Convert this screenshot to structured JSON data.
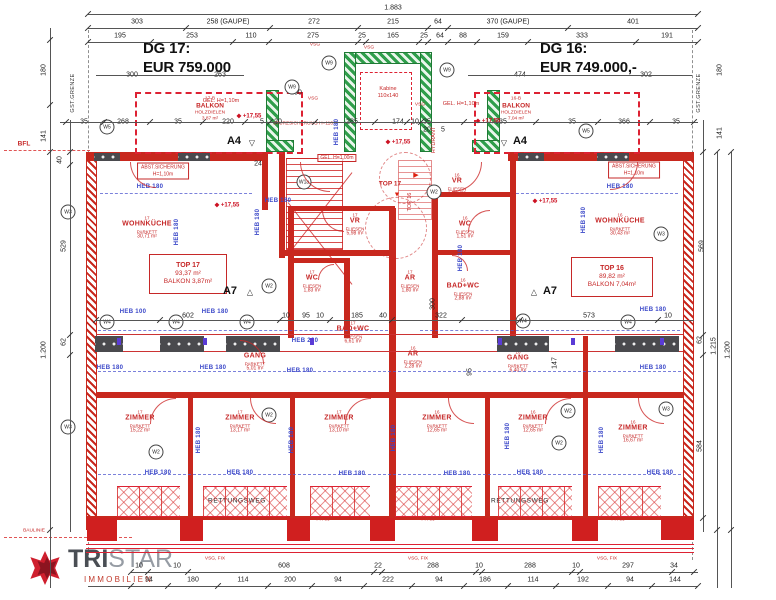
{
  "colors": {
    "wall_red": "#c8281e",
    "core_green": "#2f9e4b",
    "heb_blue": "#3946c8",
    "dim_text": "#222222",
    "room_red": "#c62828",
    "price_text": "#111111",
    "logo_red": "#c0392b"
  },
  "prices": {
    "left_label": "DG 17:",
    "left_value": "EUR 759.000",
    "right_label": "DG 16:",
    "right_value": "EUR 749.000,-"
  },
  "logo": {
    "word_bold": "TRI",
    "word_light": "STAR",
    "subtitle": "IMMOBILIEN"
  },
  "level_icon": "◆",
  "dim_rows": [
    {
      "y": 8,
      "items": [
        {
          "t": "1.883",
          "x": 393
        }
      ]
    },
    {
      "y": 22,
      "items": [
        {
          "t": "303",
          "x": 137
        },
        {
          "t": "258 (GAUPE)",
          "x": 228
        },
        {
          "t": "272",
          "x": 314
        },
        {
          "t": "215",
          "x": 393
        },
        {
          "t": "64",
          "x": 438
        },
        {
          "t": "370 (GAUPE)",
          "x": 508
        },
        {
          "t": "401",
          "x": 633
        }
      ]
    },
    {
      "y": 36,
      "items": [
        {
          "t": "195",
          "x": 120
        },
        {
          "t": "253",
          "x": 192
        },
        {
          "t": "110",
          "x": 251
        },
        {
          "t": "275",
          "x": 313
        },
        {
          "t": "25",
          "x": 362
        },
        {
          "t": "165",
          "x": 393
        },
        {
          "t": "25",
          "x": 424
        },
        {
          "t": "64",
          "x": 440
        },
        {
          "t": "88",
          "x": 463
        },
        {
          "t": "159",
          "x": 503
        },
        {
          "t": "333",
          "x": 582
        },
        {
          "t": "191",
          "x": 667
        }
      ]
    },
    {
      "y": 75,
      "items": [
        {
          "t": "300",
          "x": 132
        },
        {
          "t": "263",
          "x": 220
        },
        {
          "t": "474",
          "x": 520
        },
        {
          "t": "302",
          "x": 646
        }
      ]
    },
    {
      "y": 93,
      "items": [
        {
          "t": "100",
          "x": 296
        }
      ]
    },
    {
      "y": 122,
      "items": [
        {
          "t": "35",
          "x": 84
        },
        {
          "t": "268",
          "x": 123
        },
        {
          "t": "35",
          "x": 178
        },
        {
          "t": "220",
          "x": 228
        },
        {
          "t": "5",
          "x": 262
        },
        {
          "t": "20",
          "x": 278
        },
        {
          "t": "285",
          "x": 352
        },
        {
          "t": "174",
          "x": 398
        },
        {
          "t": "10",
          "x": 415
        },
        {
          "t": "35",
          "x": 427
        },
        {
          "t": "335",
          "x": 501
        },
        {
          "t": "35",
          "x": 572
        },
        {
          "t": "366",
          "x": 624
        },
        {
          "t": "35",
          "x": 676
        }
      ]
    },
    {
      "y": 130,
      "items": [
        {
          "t": "20",
          "x": 427
        },
        {
          "t": "5",
          "x": 443
        }
      ]
    },
    {
      "y": 164,
      "items": [
        {
          "t": "24",
          "x": 258
        }
      ]
    },
    {
      "y": 316,
      "items": [
        {
          "t": "602",
          "x": 188
        },
        {
          "t": "10",
          "x": 286
        },
        {
          "t": "95",
          "x": 306
        },
        {
          "t": "10",
          "x": 320
        },
        {
          "t": "185",
          "x": 357
        },
        {
          "t": "40",
          "x": 383
        },
        {
          "t": "322",
          "x": 441
        },
        {
          "t": "573",
          "x": 589
        },
        {
          "t": "10",
          "x": 668
        }
      ]
    },
    {
      "y": 566,
      "items": [
        {
          "t": "10",
          "x": 139
        },
        {
          "t": "10",
          "x": 177
        },
        {
          "t": "608",
          "x": 284
        },
        {
          "t": "22",
          "x": 378
        },
        {
          "t": "288",
          "x": 433
        },
        {
          "t": "10",
          "x": 479
        },
        {
          "t": "288",
          "x": 530
        },
        {
          "t": "10",
          "x": 576
        },
        {
          "t": "297",
          "x": 628
        },
        {
          "t": "34",
          "x": 674
        }
      ]
    },
    {
      "y": 580,
      "items": [
        {
          "t": "94",
          "x": 149
        },
        {
          "t": "180",
          "x": 193
        },
        {
          "t": "114",
          "x": 243
        },
        {
          "t": "200",
          "x": 290
        },
        {
          "t": "94",
          "x": 338
        },
        {
          "t": "222",
          "x": 388
        },
        {
          "t": "94",
          "x": 439
        },
        {
          "t": "186",
          "x": 485
        },
        {
          "t": "114",
          "x": 533
        },
        {
          "t": "192",
          "x": 583
        },
        {
          "t": "94",
          "x": 630
        },
        {
          "t": "144",
          "x": 675
        }
      ]
    }
  ],
  "dim_side": [
    {
      "t": "180",
      "x": 44,
      "y": 70
    },
    {
      "t": "141",
      "x": 44,
      "y": 136
    },
    {
      "t": "40",
      "x": 60,
      "y": 160
    },
    {
      "t": "529",
      "x": 64,
      "y": 246
    },
    {
      "t": "62",
      "x": 64,
      "y": 342
    },
    {
      "t": "1.200",
      "x": 44,
      "y": 350
    },
    {
      "t": "180",
      "x": 720,
      "y": 70
    },
    {
      "t": "141",
      "x": 720,
      "y": 133
    },
    {
      "t": "569",
      "x": 702,
      "y": 246
    },
    {
      "t": "62",
      "x": 700,
      "y": 340
    },
    {
      "t": "584",
      "x": 700,
      "y": 446
    },
    {
      "t": "1.215",
      "x": 714,
      "y": 346
    },
    {
      "t": "1.200",
      "x": 728,
      "y": 350
    },
    {
      "t": "300",
      "x": 433,
      "y": 304
    },
    {
      "t": "95",
      "x": 470,
      "y": 372
    },
    {
      "t": "147",
      "x": 555,
      "y": 363
    }
  ],
  "heb": [
    {
      "t": "HEB 180",
      "x": 150,
      "y": 187
    },
    {
      "t": "HEB 180",
      "x": 620,
      "y": 187
    },
    {
      "t": "HEB 180",
      "x": 278,
      "y": 201
    },
    {
      "t": "HEB 100",
      "x": 133,
      "y": 312
    },
    {
      "t": "HEB 180",
      "x": 215,
      "y": 312
    },
    {
      "t": "HEB 180",
      "x": 653,
      "y": 310
    },
    {
      "t": "HEB 220",
      "x": 305,
      "y": 341
    },
    {
      "t": "HEB 180",
      "x": 110,
      "y": 368
    },
    {
      "t": "HEB 180",
      "x": 213,
      "y": 368
    },
    {
      "t": "HEB 180",
      "x": 300,
      "y": 371
    },
    {
      "t": "HEB 180",
      "x": 653,
      "y": 368
    },
    {
      "t": "HEB 180",
      "x": 158,
      "y": 473
    },
    {
      "t": "HEB 180",
      "x": 240,
      "y": 473
    },
    {
      "t": "HEB 180",
      "x": 352,
      "y": 474
    },
    {
      "t": "HEB 180",
      "x": 457,
      "y": 474
    },
    {
      "t": "HEB 180",
      "x": 530,
      "y": 473
    },
    {
      "t": "HEB 180",
      "x": 660,
      "y": 473
    },
    {
      "t": "HEB 180",
      "x": 177,
      "y": 232,
      "v": 1
    },
    {
      "t": "HEB 180",
      "x": 258,
      "y": 222,
      "v": 1
    },
    {
      "t": "HEB 180",
      "x": 584,
      "y": 220,
      "v": 1
    },
    {
      "t": "HEB 180",
      "x": 337,
      "y": 132,
      "v": 1
    },
    {
      "t": "HEB 180",
      "x": 461,
      "y": 258,
      "v": 1
    },
    {
      "t": "HEB 180",
      "x": 199,
      "y": 440,
      "v": 1
    },
    {
      "t": "HEB 180",
      "x": 292,
      "y": 440,
      "v": 1
    },
    {
      "t": "HEB 180",
      "x": 394,
      "y": 438,
      "v": 1
    },
    {
      "t": "HEB 180",
      "x": 508,
      "y": 436,
      "v": 1
    },
    {
      "t": "HEB 180",
      "x": 602,
      "y": 440,
      "v": 1
    }
  ],
  "circles": [
    {
      "t": "W5",
      "x": 107,
      "y": 127
    },
    {
      "t": "W9",
      "x": 329,
      "y": 63
    },
    {
      "t": "W9",
      "x": 292,
      "y": 87
    },
    {
      "t": "W9",
      "x": 447,
      "y": 70
    },
    {
      "t": "W5",
      "x": 586,
      "y": 131
    },
    {
      "t": "W1a",
      "x": 304,
      "y": 182
    },
    {
      "t": "W3",
      "x": 68,
      "y": 212
    },
    {
      "t": "W3",
      "x": 661,
      "y": 234
    },
    {
      "t": "W2",
      "x": 269,
      "y": 286
    },
    {
      "t": "W2",
      "x": 434,
      "y": 192
    },
    {
      "t": "W4",
      "x": 107,
      "y": 322
    },
    {
      "t": "W4",
      "x": 176,
      "y": 322
    },
    {
      "t": "W4",
      "x": 247,
      "y": 322
    },
    {
      "t": "W4",
      "x": 523,
      "y": 321
    },
    {
      "t": "W4",
      "x": 628,
      "y": 322
    },
    {
      "t": "W2",
      "x": 269,
      "y": 415
    },
    {
      "t": "W2",
      "x": 156,
      "y": 452
    },
    {
      "t": "W2",
      "x": 568,
      "y": 411
    },
    {
      "t": "W2",
      "x": 559,
      "y": 443
    },
    {
      "t": "W3",
      "x": 666,
      "y": 409
    },
    {
      "t": "W3",
      "x": 68,
      "y": 427
    }
  ],
  "levels": [
    {
      "t": "+17,55",
      "x": 227,
      "y": 205
    },
    {
      "t": "+17,55",
      "x": 545,
      "y": 201
    },
    {
      "t": "+17,55",
      "x": 398,
      "y": 142
    },
    {
      "t": "+17,55",
      "x": 249,
      "y": 116
    },
    {
      "t": "+17,55",
      "x": 488,
      "y": 121
    }
  ],
  "rooms": [
    {
      "no": "17",
      "nm": "WOHNKÜCHE",
      "sb": "PARKETT",
      "ar": "30,71 m²",
      "x": 147,
      "y": 228
    },
    {
      "no": "16",
      "nm": "WOHNKÜCHE",
      "sb": "PARKETT",
      "ar": "30,43 m²",
      "x": 620,
      "y": 225
    },
    {
      "no": "17",
      "nm": "VR",
      "sb": "FLIESEN",
      "ar": "5,98 m²",
      "x": 355,
      "y": 225
    },
    {
      "no": "16",
      "nm": "VR",
      "sb": "FLIESEN",
      "ar": "5,31 m²",
      "x": 457,
      "y": 185
    },
    {
      "no": "17",
      "nm": "WC",
      "sb": "FLIESEN",
      "ar": "1,83 m²",
      "x": 312,
      "y": 282
    },
    {
      "no": "16",
      "nm": "WC",
      "sb": "FLIESEN",
      "ar": "1,51 m²",
      "x": 465,
      "y": 228
    },
    {
      "no": "17",
      "nm": "AR",
      "sb": "FLIESEN",
      "ar": "1,80 m²",
      "x": 410,
      "y": 282
    },
    {
      "no": "16",
      "nm": "BAD+WC",
      "sb": "FLIESEN",
      "ar": "2,88 m²",
      "x": 463,
      "y": 290
    },
    {
      "no": "17",
      "nm": "BAD+WC",
      "sb": "FLIESEN",
      "ar": "6,61 m²",
      "x": 353,
      "y": 333
    },
    {
      "no": "16",
      "nm": "AR",
      "sb": "FLIESEN",
      "ar": "2,28 m²",
      "x": 413,
      "y": 358
    },
    {
      "no": "17",
      "nm": "GANG",
      "sb": "PARKETT",
      "ar": "5,01 m²",
      "x": 255,
      "y": 360
    },
    {
      "no": "16",
      "nm": "GANG",
      "sb": "PARKETT",
      "ar": "6,40 m²",
      "x": 518,
      "y": 362
    },
    {
      "no": "17",
      "nm": "ZIMMER",
      "sb": "PARKETT",
      "ar": "15,22 m²",
      "x": 140,
      "y": 422
    },
    {
      "no": "17",
      "nm": "ZIMMER",
      "sb": "PARKETT",
      "ar": "13,17 m²",
      "x": 240,
      "y": 422
    },
    {
      "no": "17",
      "nm": "ZIMMER",
      "sb": "PARKETT",
      "ar": "13,10 m²",
      "x": 339,
      "y": 422
    },
    {
      "no": "16",
      "nm": "ZIMMER",
      "sb": "PARKETT",
      "ar": "12,65 m²",
      "x": 437,
      "y": 422
    },
    {
      "no": "16",
      "nm": "ZIMMER",
      "sb": "PARKETT",
      "ar": "12,65 m²",
      "x": 533,
      "y": 422
    },
    {
      "no": "16",
      "nm": "ZIMMER",
      "sb": "PARKETT",
      "ar": "16,67 m²",
      "x": 633,
      "y": 432
    }
  ],
  "units": [
    {
      "u1": "TOP 17",
      "u2": "93,37 m²",
      "u3": "BALKON 3,87m²",
      "x": 149,
      "y": 254,
      "w": 78,
      "h": 40
    },
    {
      "u1": "TOP 16",
      "u2": "89,82 m²",
      "u3": "BALKON 7,04m²",
      "x": 571,
      "y": 257,
      "w": 82,
      "h": 40
    }
  ],
  "abst": [
    {
      "l1": "ABST.SICHERUNG",
      "l2": "H=1,10m",
      "x": 163,
      "y": 171
    },
    {
      "l1": "ABST.SICHERUNG",
      "l2": "H=1,10m",
      "x": 634,
      "y": 170
    }
  ],
  "texts": [
    {
      "t": "STURZSICHERUNG H=110",
      "x": 303,
      "y": 124,
      "c": "t-r5"
    },
    {
      "t": "GEL. H=1,00m",
      "x": 337,
      "y": 158,
      "c": "t-boxr"
    },
    {
      "t": "GEL. H=1,10m",
      "x": 221,
      "y": 101,
      "c": "t-r"
    },
    {
      "t": "GEL. H=1,10m",
      "x": 461,
      "y": 104,
      "c": "t-r"
    },
    {
      "t": "HYDRANT",
      "x": 434,
      "y": 140,
      "c": "t-rv"
    },
    {
      "t": "Kabine",
      "x": 388,
      "y": 89,
      "c": "t-r"
    },
    {
      "t": "110x140",
      "x": 388,
      "y": 96,
      "c": "t-r"
    },
    {
      "t": "VSG",
      "x": 315,
      "y": 45,
      "c": "t-r5"
    },
    {
      "t": "VSG",
      "x": 369,
      "y": 48,
      "c": "t-r5"
    },
    {
      "t": "VSG",
      "x": 313,
      "y": 99,
      "c": "t-r5"
    },
    {
      "t": "VSG",
      "x": 420,
      "y": 105,
      "c": "t-r5"
    },
    {
      "t": "VSG, FIX",
      "x": 215,
      "y": 559,
      "c": "t-r5"
    },
    {
      "t": "VSG, FIX",
      "x": 418,
      "y": 559,
      "c": "t-r5"
    },
    {
      "t": "VSG, FIX",
      "x": 607,
      "y": 559,
      "c": "t-r5"
    },
    {
      "t": "PH 86",
      "x": 135,
      "y": 519,
      "c": "t-r5"
    },
    {
      "t": "PH 86",
      "x": 227,
      "y": 519,
      "c": "t-r5"
    },
    {
      "t": "PH 86",
      "x": 323,
      "y": 520,
      "c": "t-r5"
    },
    {
      "t": "PH 86",
      "x": 428,
      "y": 520,
      "c": "t-r5"
    },
    {
      "t": "PH 86",
      "x": 524,
      "y": 519,
      "c": "t-r5"
    },
    {
      "t": "PH 86",
      "x": 618,
      "y": 520,
      "c": "t-r5"
    },
    {
      "t": "BFL",
      "x": 24,
      "y": 144,
      "c": "t-rb"
    },
    {
      "t": "BAULINIE",
      "x": 34,
      "y": 531,
      "c": "t-r5"
    },
    {
      "t": "TOP 17",
      "x": 390,
      "y": 184,
      "c": "t-rb"
    },
    {
      "t": "TOP 16",
      "x": 410,
      "y": 202,
      "c": "t-rv"
    },
    {
      "t": "▶",
      "x": 416,
      "y": 175,
      "c": "t-rtri"
    },
    {
      "t": "▼",
      "x": 397,
      "y": 195,
      "c": "t-rtri"
    },
    {
      "t": "RETTUNGSWEG",
      "x": 237,
      "y": 501,
      "c": "t-b"
    },
    {
      "t": "RETTUNGSWEG",
      "x": 520,
      "y": 501,
      "c": "t-b"
    },
    {
      "t": "GST.GRENZE",
      "x": 73,
      "y": 93,
      "c": "t-bv"
    },
    {
      "t": "GST.GRENZE",
      "x": 699,
      "y": 93,
      "c": "t-bv"
    },
    {
      "t": "17-B",
      "x": 210,
      "y": 99,
      "c": "t-r5"
    },
    {
      "t": "BALKON",
      "x": 210,
      "y": 106,
      "c": "t-rb"
    },
    {
      "t": "HOLZDIELEN",
      "x": 210,
      "y": 113,
      "c": "t-r5"
    },
    {
      "t": "3,87 m²",
      "x": 210,
      "y": 119,
      "c": "t-r5"
    },
    {
      "t": "16-B",
      "x": 516,
      "y": 99,
      "c": "t-r5"
    },
    {
      "t": "BALKON",
      "x": 516,
      "y": 106,
      "c": "t-rb"
    },
    {
      "t": "HOLZDIELEN",
      "x": 516,
      "y": 113,
      "c": "t-r5"
    },
    {
      "t": "7,04 m²",
      "x": 516,
      "y": 119,
      "c": "t-r5"
    },
    {
      "t": "A4",
      "x": 234,
      "y": 141,
      "c": "t-mk"
    },
    {
      "t": "▽",
      "x": 252,
      "y": 143,
      "c": "t-mtri"
    },
    {
      "t": "A4",
      "x": 520,
      "y": 141,
      "c": "t-mk"
    },
    {
      "t": "▽",
      "x": 504,
      "y": 143,
      "c": "t-mtri"
    },
    {
      "t": "A7",
      "x": 230,
      "y": 291,
      "c": "t-mk"
    },
    {
      "t": "△",
      "x": 250,
      "y": 292,
      "c": "t-mtri"
    },
    {
      "t": "A7",
      "x": 550,
      "y": 291,
      "c": "t-mk"
    },
    {
      "t": "△",
      "x": 534,
      "y": 292,
      "c": "t-mtri"
    }
  ]
}
